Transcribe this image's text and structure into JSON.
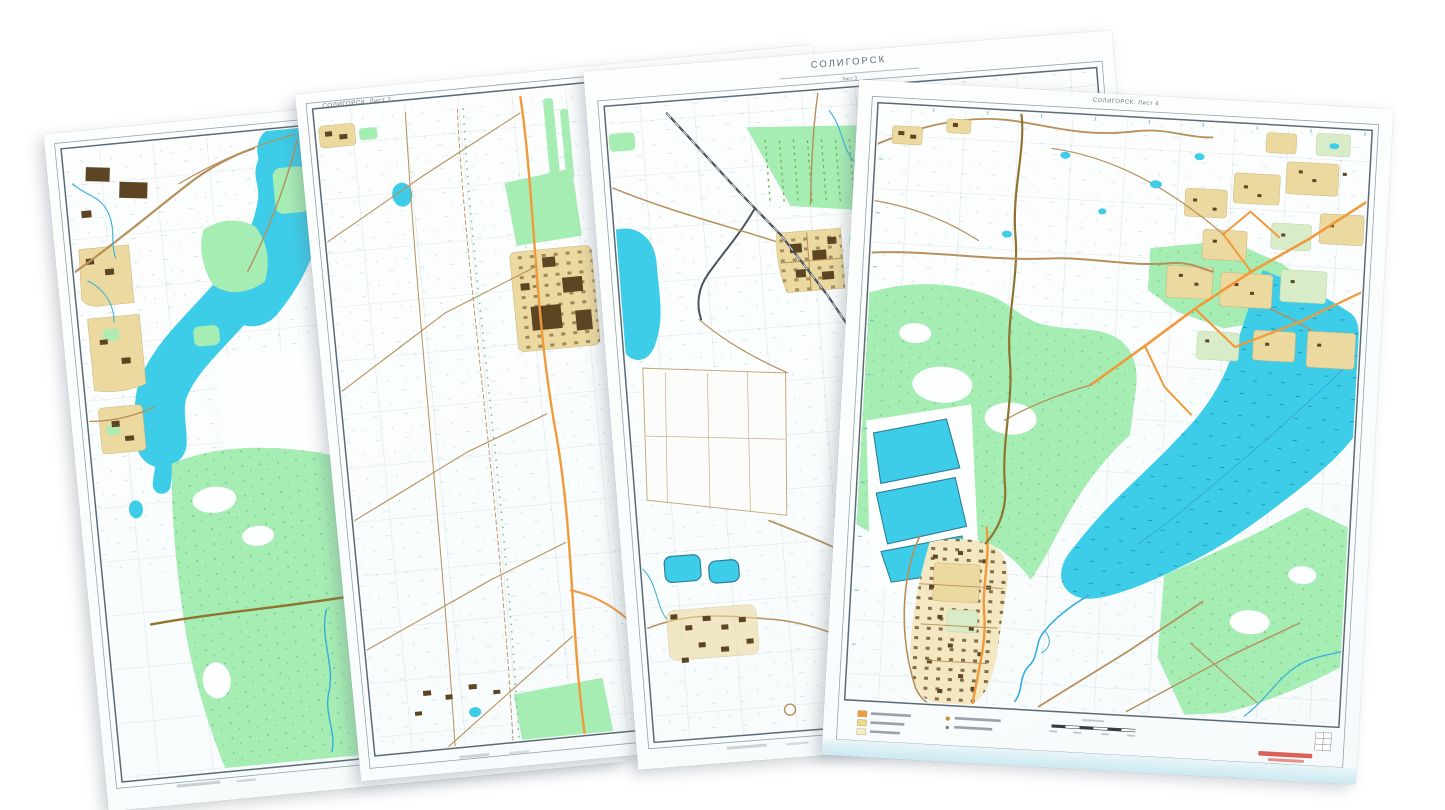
{
  "scene": {
    "background_color": "#FFFFFF",
    "series_title": "СОЛИГОРСК",
    "sheet_count": 4
  },
  "sheets": [
    {
      "id": "sheet-1"
    },
    {
      "id": "sheet-2",
      "label": "СОЛИГОРСК. Лист 2"
    },
    {
      "id": "sheet-3",
      "label": "СОЛИГОРСК",
      "sublabel": "Лист 3"
    },
    {
      "id": "sheet-4",
      "label": "СОЛИГОРСК. Лист 4"
    }
  ],
  "palette": {
    "water": "#3ECDE8",
    "forest": "#A6EDB4",
    "road_primary": "#F09A3C",
    "road_secondary": "#B6905A",
    "railway": "#4A545E",
    "urban_block": "#ECD9A0",
    "building": "#5D4423",
    "grid": "#B7C7D1",
    "frame": "#5A6A74",
    "watermark": "#D23B2F",
    "legend_swatches": [
      "#F09A3C",
      "#EFD98A",
      "#F7EFC8"
    ]
  }
}
